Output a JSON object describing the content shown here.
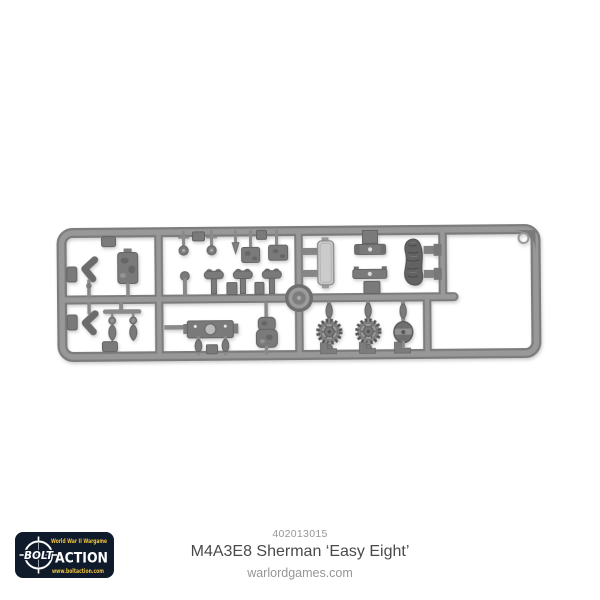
{
  "page": {
    "kind": "product-photo"
  },
  "colors": {
    "background": "#ffffff",
    "sprue-gray": "#989898",
    "sprue-dark": "#7c7c7c",
    "part-mid": "#7a7a7a",
    "part-dark": "#626262",
    "part-light": "#cbcbcb",
    "logo-navy": "#0f1b2a",
    "logo-yellow": "#eec23e",
    "text-dark": "#4a4a4a",
    "text-gray": "#969696"
  },
  "product": {
    "code": "402013015",
    "title": "M4A3E8 Sherman ‘Easy Eight’",
    "website": "warlordgames.com"
  },
  "logo": {
    "tagline": "World War II Wargame",
    "brand_left": "BOLT",
    "brand_right": "ACTION",
    "url": "www.boltaction.com"
  },
  "sprue": {
    "description": "Grey injection-moulded plastic sprue of M4A3E8 Sherman tank parts",
    "parts": [
      "lifting-hook",
      "stowage-box",
      "lifting-hook",
      "tow-shackles",
      "periscope-pins",
      "hatch-boxes",
      "antenna-mounts",
      "crew-hatch-door",
      "hinge-brackets",
      "tarpaulin-roll",
      "round-hatch",
      "engine-deck-plate",
      "bullet-pendants",
      "gun-mantlet",
      "drive-sprocket",
      "drive-sprocket",
      "idler-wheel"
    ]
  }
}
